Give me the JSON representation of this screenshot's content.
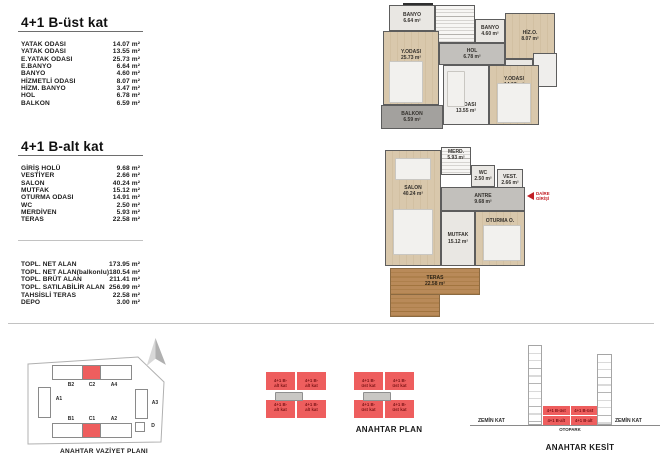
{
  "area_table_upper": {
    "title": "4+1 B-üst kat",
    "rows": [
      {
        "label": "YATAK ODASI",
        "value": "14.07 m²"
      },
      {
        "label": "YATAK ODASI",
        "value": "13.55 m²"
      },
      {
        "label": "E.YATAK ODASI",
        "value": "25.73 m²"
      },
      {
        "label": "E.BANYO",
        "value": "6.64 m²"
      },
      {
        "label": "BANYO",
        "value": "4.60 m²"
      },
      {
        "label": "HİZMETLİ ODASI",
        "value": "8.07 m²"
      },
      {
        "label": "HİZM. BANYO",
        "value": "3.47 m²"
      },
      {
        "label": "HOL",
        "value": "6.78 m²"
      },
      {
        "label": "BALKON",
        "value": "6.59 m²"
      }
    ]
  },
  "area_table_lower": {
    "title": "4+1 B-alt kat",
    "rows": [
      {
        "label": "GİRİŞ HOLÜ",
        "value": "9.68 m²"
      },
      {
        "label": "VESTİYER",
        "value": "2.66 m²"
      },
      {
        "label": "SALON",
        "value": "40.24 m²"
      },
      {
        "label": "MUTFAK",
        "value": "15.12 m²"
      },
      {
        "label": "OTURMA ODASI",
        "value": "14.91 m²"
      },
      {
        "label": "WC",
        "value": "2.50 m²"
      },
      {
        "label": "MERDİVEN",
        "value": "5.93 m²"
      },
      {
        "label": "TERAS",
        "value": "22.58 m²"
      }
    ]
  },
  "totals": {
    "rows": [
      {
        "label": "TOPL. NET ALAN",
        "value": "173.95 m²"
      },
      {
        "label": "TOPL. NET ALAN(balkonlu)",
        "value": "180.54 m²"
      },
      {
        "label": "TOPL. BRÜT ALAN",
        "value": "211.41 m²"
      },
      {
        "label": "TOPL. SATILABİLİR ALAN",
        "value": "256.99 m²"
      },
      {
        "label": "TAHSİSLİ TERAS",
        "value": "22.58 m²"
      },
      {
        "label": "DEPO",
        "value": "3.00 m²"
      }
    ]
  },
  "upper_plan": {
    "rooms": {
      "ebanyo": {
        "name": "BANYO",
        "area": "6.64 m²"
      },
      "master": {
        "name": "Y.ODASI",
        "area": "25.73 m²"
      },
      "banyo": {
        "name": "BANYO",
        "area": "4.60 m²"
      },
      "hol": {
        "name": "HOL",
        "area": "6.78 m²"
      },
      "hiz_o": {
        "name": "HİZ.O.",
        "area": "8.07 m²"
      },
      "hizm_banyo": {
        "name": "BANYO",
        "area": "3.47 m²"
      },
      "bedroom2": {
        "name": "Y.ODASI",
        "area": "13.55 m²"
      },
      "bedroom3": {
        "name": "Y.ODASI",
        "area": "14.07 m²"
      },
      "balkon": {
        "name": "BALKON",
        "area": "6.59 m²"
      }
    }
  },
  "lower_plan": {
    "rooms": {
      "merdiven": {
        "name": "MERD.",
        "area": "5.93 m²"
      },
      "wc": {
        "name": "WC",
        "area": "2.50 m²"
      },
      "vestiyer": {
        "name": "VEST.",
        "area": "2.66 m²"
      },
      "antre": {
        "name": "ANTRE",
        "area": "9.68 m²"
      },
      "salon": {
        "name": "SALON",
        "area": "40.24 m²"
      },
      "mutfak": {
        "name": "MUTFAK",
        "area": "15.12 m²"
      },
      "oturma": {
        "name": "OTURMA O.",
        "area": "14.91 m²"
      },
      "teras": {
        "name": "TERAS",
        "area": "22.58 m²"
      }
    },
    "entrance": {
      "line1": "DAİRE",
      "line2": "GİRİŞİ"
    }
  },
  "site_plan": {
    "caption": "ANAHTAR VAZİYET PLANI",
    "blocks": {
      "b2": "B2",
      "c2": "C2",
      "a4": "A4",
      "a1": "A1",
      "a3": "A3",
      "b1": "B1",
      "c1": "C1",
      "a2": "A2",
      "d": "D"
    }
  },
  "key_plan": {
    "caption": "ANAHTAR PLAN",
    "alt_line1": "4+1 B-",
    "alt_line2": "alt kat",
    "ust_line1": "4+1 B-",
    "ust_line2": "üst kat"
  },
  "key_section": {
    "caption": "ANAHTAR KESİT",
    "zemin_left": "ZEMİN KAT",
    "zemin_right": "ZEMİN KAT",
    "otopark": "OTOPARK",
    "ust": "4+1 B-üst",
    "alt": "4+1 B-alt"
  },
  "colors": {
    "highlight_red": "#ee5e5e",
    "red_text": "#7e1517",
    "arrow_red": "#c22026",
    "wall_gray": "#5d5d5d",
    "wood_floor": "#d9c8ac",
    "terrace_wood": "#b08052"
  }
}
